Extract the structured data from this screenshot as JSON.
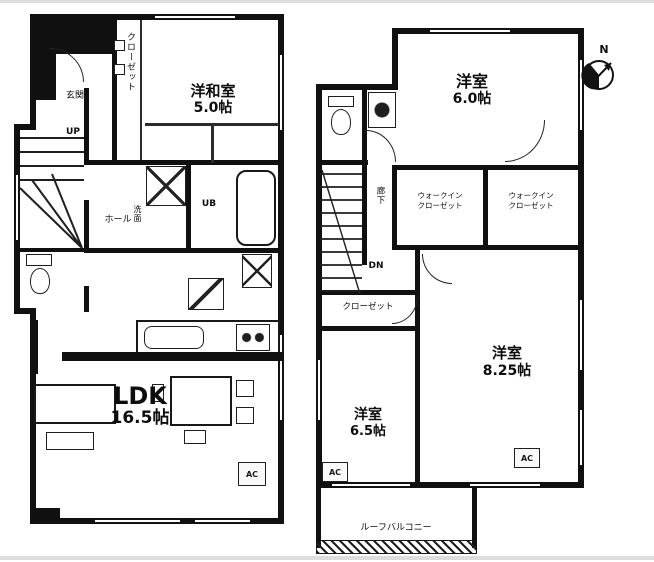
{
  "floor1": {
    "closet_label": "クローゼット",
    "room1_name": "洋和室",
    "room1_size": "5.0帖",
    "up_label": "UP",
    "genkan_label": "玄関",
    "hall_label": "ホール",
    "senmen_label": "洗面",
    "ub_label": "UB",
    "ldk_name": "LDK",
    "ldk_size": "16.5帖",
    "ac_label": "AC"
  },
  "floor2": {
    "room1_name": "洋室",
    "room1_size": "6.0帖",
    "wic1_line1": "ウォークイン",
    "wic1_line2": "クローゼット",
    "wic2_line1": "ウォークイン",
    "wic2_line2": "クローゼット",
    "hall_label": "廊下",
    "dn_label": "DN",
    "closet_label": "クローゼット",
    "room2_name": "洋室",
    "room2_size": "6.5帖",
    "room3_name": "洋室",
    "room3_size": "8.25帖",
    "balcony_label": "ルーフバルコニー",
    "ac1_label": "AC",
    "ac2_label": "AC",
    "compass_label": "N"
  }
}
